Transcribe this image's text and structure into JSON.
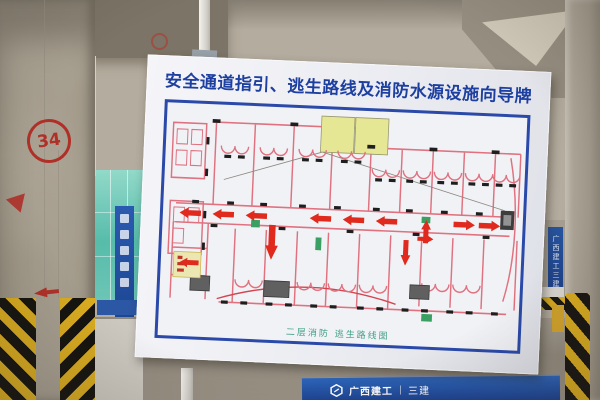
{
  "board": {
    "title": "安全通道指引、逃生路线及消防水源设施向导牌",
    "map_caption": "二层消防 逃生路线图"
  },
  "pillar": {
    "column_number": "34"
  },
  "bottom_banner": {
    "brand": "广西建工",
    "divider": "|",
    "division": "三建"
  },
  "distant_banner": {
    "text": "广西建工三建"
  },
  "colors": {
    "title_blue": "#1d3fa0",
    "frame_blue": "#2a49a8",
    "route_arrow_red": "#df2a1d",
    "plan_wall_pink": "#e0717f",
    "legend_yellow": "#e6e795",
    "caption_green": "#3f9f86",
    "banner_blue": "#1b3f8f",
    "hazard_yellow": "#d9ab20",
    "glass_teal": "#57bcab"
  }
}
